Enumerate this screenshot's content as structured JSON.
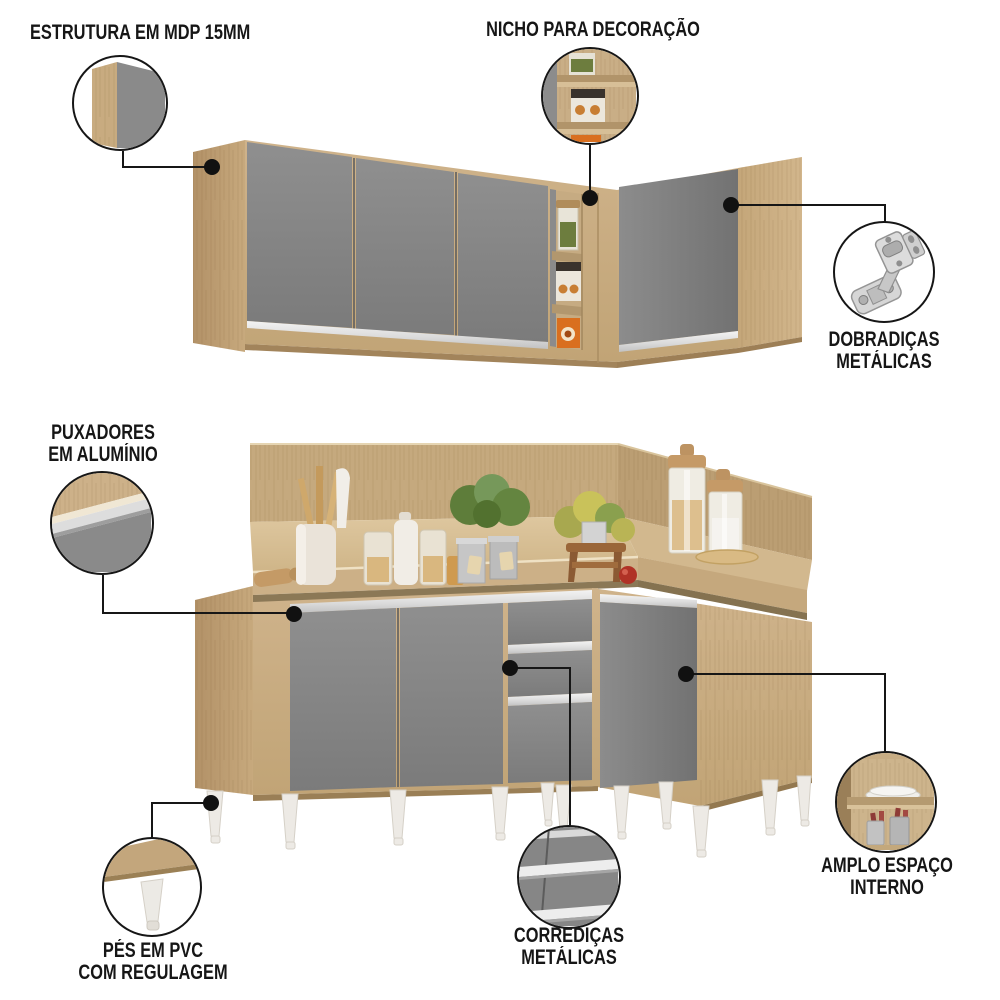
{
  "callouts": {
    "estrutura": {
      "line1": "ESTRUTURA EM MDP 15MM",
      "icon": "corner-structure-zoom-icon"
    },
    "nicho": {
      "line1": "NICHO PARA DECORAÇÃO",
      "icon": "niche-zoom-icon"
    },
    "dobradicas": {
      "line1": "DOBRADIÇAS",
      "line2": "METÁLICAS",
      "icon": "metal-hinge-icon"
    },
    "puxadores": {
      "line1": "PUXADORES",
      "line2": "EM ALUMÍNIO",
      "icon": "aluminum-handle-zoom-icon"
    },
    "pes": {
      "line1": "PÉS EM PVC",
      "line2": "COM REGULAGEM",
      "icon": "pvc-leg-zoom-icon"
    },
    "corredicas": {
      "line1": "CORREDIÇAS",
      "line2": "METÁLICAS",
      "icon": "drawer-slide-zoom-icon"
    },
    "amplo": {
      "line1": "AMPLO ESPAÇO",
      "line2": "INTERNO",
      "icon": "interior-space-zoom-icon"
    }
  },
  "colors": {
    "wood": "#c9ae86",
    "wood_dark": "#b59468",
    "wood_light": "#dcc59d",
    "door_gray": "#848484",
    "aluminum": "#e7e7e7",
    "leg_white": "#edeae5",
    "callout_line": "#161616",
    "niche_box_orange": "#d96f1f",
    "plant_green": "#6f8c46"
  }
}
